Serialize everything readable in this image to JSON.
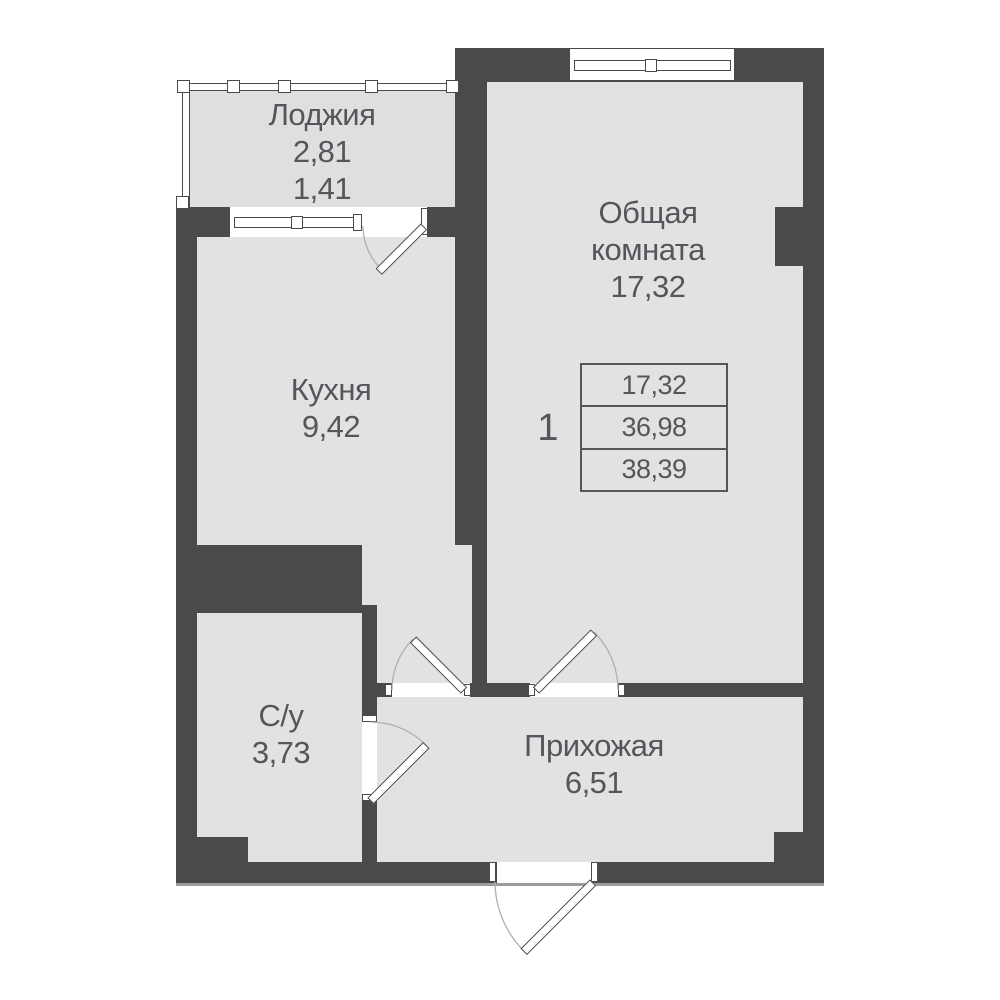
{
  "colors": {
    "bg": "#ffffff",
    "wall": "#4a4a4b",
    "floor": "#e2e2e2",
    "loggia-floor": "#dfdfdf",
    "outline": "#4a4a4b",
    "text": "#55565b",
    "arc": "#b0b0b0",
    "table-border": "#55565b",
    "shadow": "#9b9b9c"
  },
  "rooms": {
    "loggia": {
      "label": "Лоджия",
      "area_total": "2,81",
      "area_counted": "1,41"
    },
    "living": {
      "label_line1": "Общая",
      "label_line2": "комната",
      "area": "17,32"
    },
    "kitchen": {
      "label": "Кухня",
      "area": "9,42"
    },
    "bathroom": {
      "label": "С/у",
      "area": "3,73"
    },
    "hallway": {
      "label": "Прихожая",
      "area": "6,51"
    }
  },
  "summary": {
    "unit_number": "1",
    "row1": "17,32",
    "row2": "36,98",
    "row3": "38,39"
  }
}
